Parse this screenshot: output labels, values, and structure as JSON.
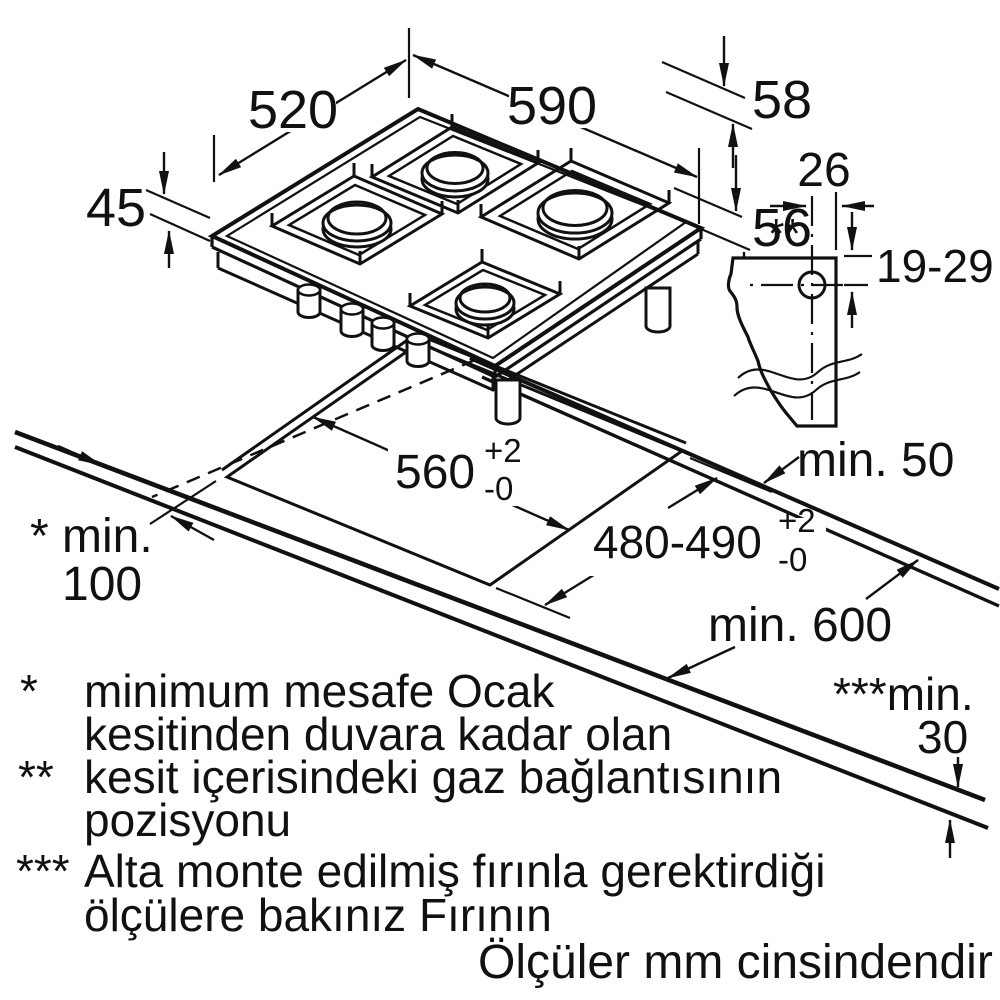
{
  "hob": {
    "width": "590",
    "depth": "520",
    "edge_height": "58",
    "tray_height": "45",
    "total_height": "56"
  },
  "gas_connection": {
    "offset": "26",
    "range": "19-29",
    "marker": "**"
  },
  "cutout": {
    "width": "560",
    "width_tol_plus": "+2",
    "width_tol_minus": "-0",
    "depth": "480-490",
    "depth_tol_plus": "+2",
    "depth_tol_minus": "-0",
    "rear_clearance": "min. 50",
    "side_clearance_label": "* min.",
    "side_clearance_value": "100",
    "counter_depth": "min. 600",
    "worktop_thickness_label": "***min.",
    "worktop_thickness_value": "30"
  },
  "notes": {
    "star1": "*",
    "line1": "minimum mesafe Ocak",
    "line2": "kesitinden duvara kadar olan",
    "star2": "**",
    "line3": "kesit içerisindeki gaz bağlantısının",
    "line4": "pozisyonu",
    "star3": "***",
    "line5": "Alta monte edilmiş fırınla gerektirdiği",
    "line6": "ölçülere bakınız Fırının",
    "footer": "Ölçüler mm cinsindendir"
  },
  "colors": {
    "ink": "#111111",
    "burner_cap": "#b3b3b3",
    "background": "#ffffff"
  }
}
